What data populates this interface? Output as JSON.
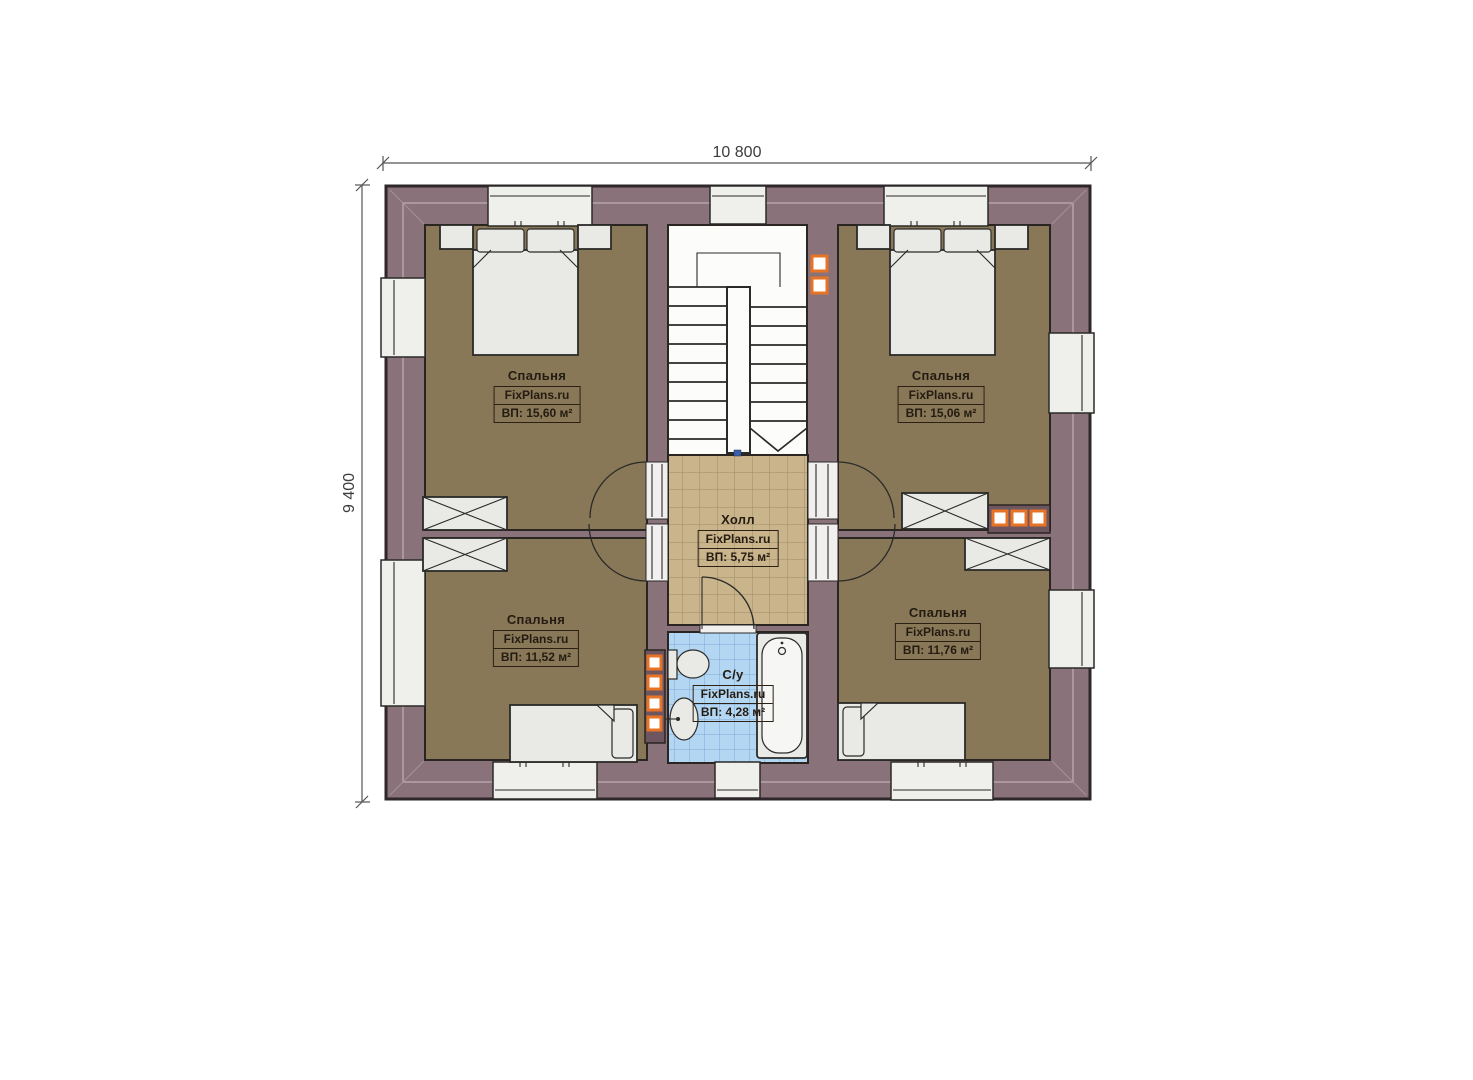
{
  "plan": {
    "dimensions": {
      "width_label": "10 800",
      "height_label": "9 400"
    },
    "rooms": [
      {
        "id": "bedroom-top-left",
        "name": "Спальня",
        "watermark": "FixPlans.ru",
        "area_label": "ВП: 15,60 м²"
      },
      {
        "id": "bedroom-top-right",
        "name": "Спальня",
        "watermark": "FixPlans.ru",
        "area_label": "ВП: 15,06 м²"
      },
      {
        "id": "bedroom-bottom-left",
        "name": "Спальня",
        "watermark": "FixPlans.ru",
        "area_label": "ВП: 11,52 м²"
      },
      {
        "id": "bedroom-bottom-right",
        "name": "Спальня",
        "watermark": "FixPlans.ru",
        "area_label": "ВП: 11,76 м²"
      },
      {
        "id": "hall",
        "name": "Холл",
        "watermark": "FixPlans.ru",
        "area_label": "ВП: 5,75 м²"
      },
      {
        "id": "bathroom",
        "name": "С/у",
        "watermark": "FixPlans.ru",
        "area_label": "ВП: 4,28 м²"
      }
    ],
    "colors": {
      "wall": "#8a727b",
      "wall-dark": "#6d5660",
      "floor-bedroom": "#887857",
      "floor-hall": "#c9b48c",
      "floor-bath": "#b3d7f2",
      "furniture": "#e9e9e6",
      "accent-orange": "#e77426",
      "text": "#241c12"
    }
  }
}
